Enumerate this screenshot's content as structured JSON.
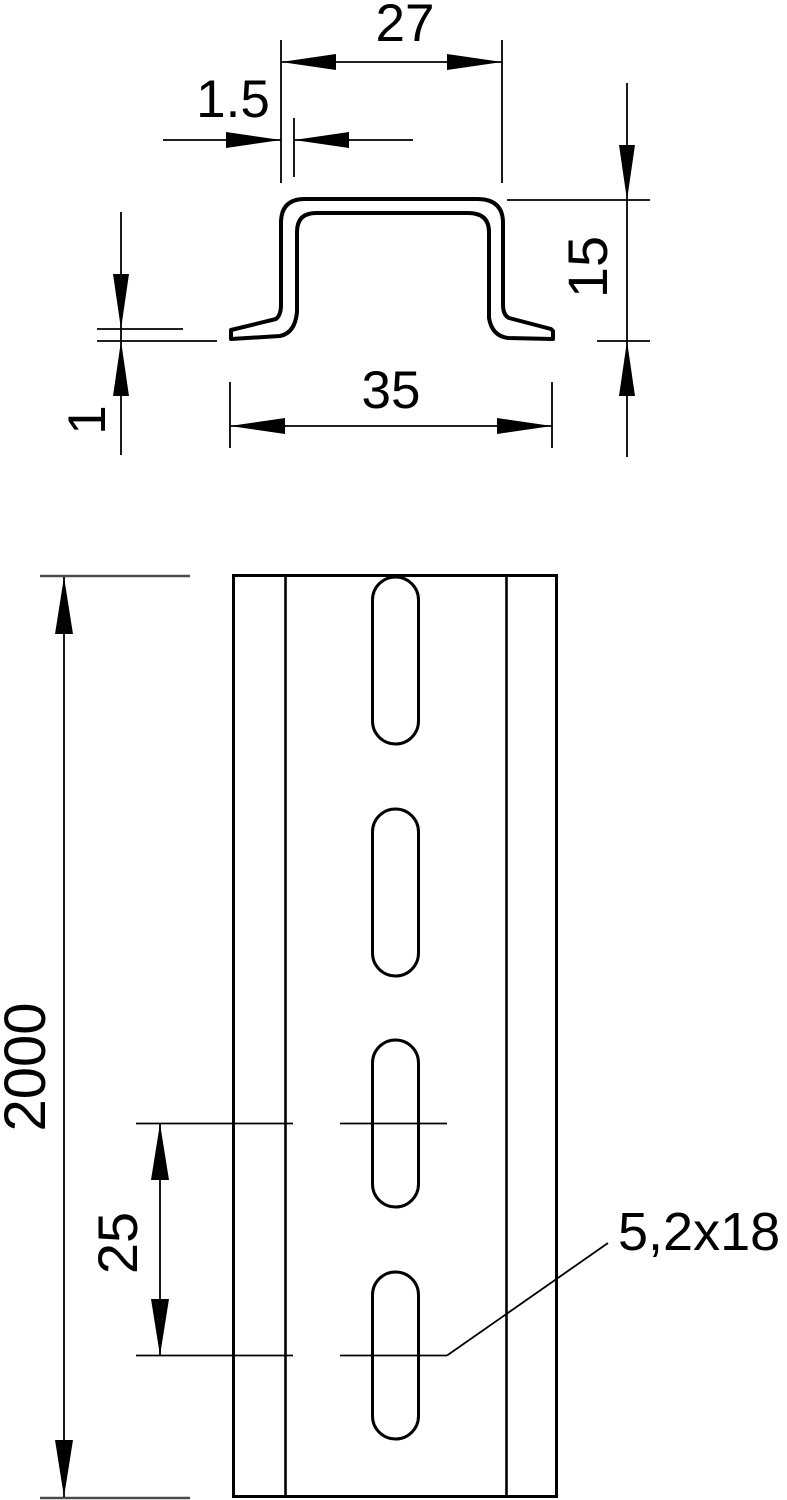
{
  "drawing": {
    "type": "technical-dimension-drawing",
    "part": "top-hat DIN rail, perforated",
    "background_color": "#ffffff",
    "line_color": "#000000",
    "datum_line_color": "#4b4b4b"
  },
  "cross_section": {
    "top_width": "27",
    "material_thickness": "1.5",
    "height": "15",
    "bottom_width": "35",
    "flange_thickness": "1"
  },
  "front_view": {
    "length": "2000",
    "slot_pitch": "25",
    "slot_size": "5,2x18",
    "slot_count": 4
  }
}
